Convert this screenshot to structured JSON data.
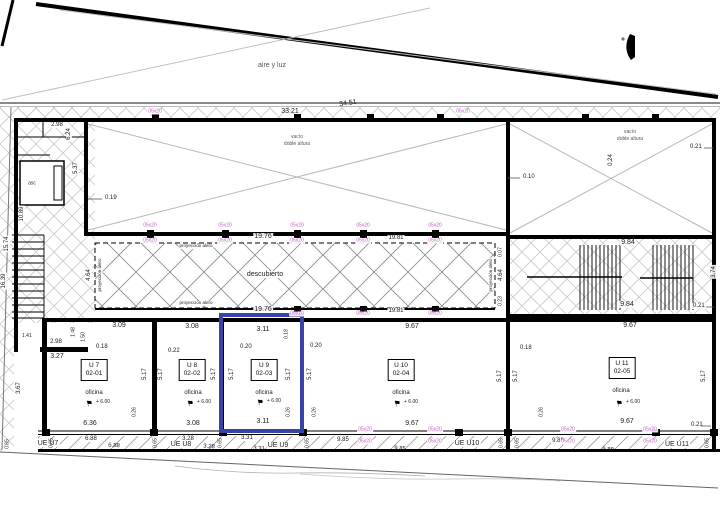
{
  "texts": {
    "aire_y_luz": "aire y luz",
    "vacio": "vacío",
    "doble_altura": "doble altura",
    "descubierto": "descubierto",
    "proyeccion_alero": "proyección alero",
    "asc": "asc"
  },
  "column_size_label": "05x20",
  "units": [
    {
      "uid": "U 7",
      "code": "02-01",
      "use": "oficina",
      "level": "+ 6.00",
      "ue": "UE U7",
      "top_dim": "3.09",
      "bottom_dim": "6.36",
      "strip_a": "6.88",
      "strip_b": "6.88"
    },
    {
      "uid": "U 8",
      "code": "02-02",
      "use": "oficina",
      "level": "+ 6.00",
      "ue": "UE U8",
      "top_dim": "3.08",
      "bottom_dim": "3.08",
      "strip_a": "3.28",
      "strip_b": "3.28"
    },
    {
      "uid": "U 9",
      "code": "02-03",
      "use": "oficina",
      "level": "+ 6.00",
      "ue": "UE U9",
      "top_dim": "3.11",
      "bottom_dim": "3.11",
      "strip_a": "3.31",
      "strip_b": "3.31"
    },
    {
      "uid": "U 10",
      "code": "02-04",
      "use": "oficina",
      "level": "+ 6.00",
      "ue": "UE U10",
      "top_dim": "9.67",
      "bottom_dim": "9.67",
      "strip_a": "9.85",
      "strip_b": "9.85"
    },
    {
      "uid": "U 11",
      "code": "02-05",
      "use": "oficina",
      "level": "+ 6.00",
      "ue": "UE U11",
      "top_dim": "9.67",
      "bottom_dim": "9.67",
      "strip_a": "9.88",
      "strip_b": "9.88"
    }
  ],
  "dims": {
    "d3321": "33.21",
    "d3451": "34.51",
    "d298": "2.98",
    "d624": "6.24",
    "d537": "5.37",
    "d019": "0.19",
    "d1089": "10.89",
    "d1574": "15.74",
    "d1639": "16.39",
    "d010": "0.10",
    "d021": "0.21",
    "d024": "0.24",
    "d1976": "19.76",
    "d1981": "19.81",
    "d464": "4.64",
    "d007": "0.07",
    "d023": "0.23",
    "d984": "9.84",
    "d967": "9.67",
    "d374": "3.74",
    "d309": "3.09",
    "d308": "3.08",
    "d311": "3.11",
    "d148": "1.48",
    "d150": "1.50",
    "d141": "1.41",
    "d018": "0.18",
    "d327": "3.27",
    "d367": "3.67",
    "d517": "5.17",
    "d020": "0.20",
    "d022": "0.22",
    "d026": "0.26",
    "d636": "6.36",
    "d688": "6.88",
    "d328": "3.28",
    "d331": "3.31",
    "d985": "9.85",
    "d988": "9.88",
    "d065": "0.65"
  },
  "colors": {
    "selection_blue": "#3743a5",
    "column_magenta": "#c45fc4"
  }
}
